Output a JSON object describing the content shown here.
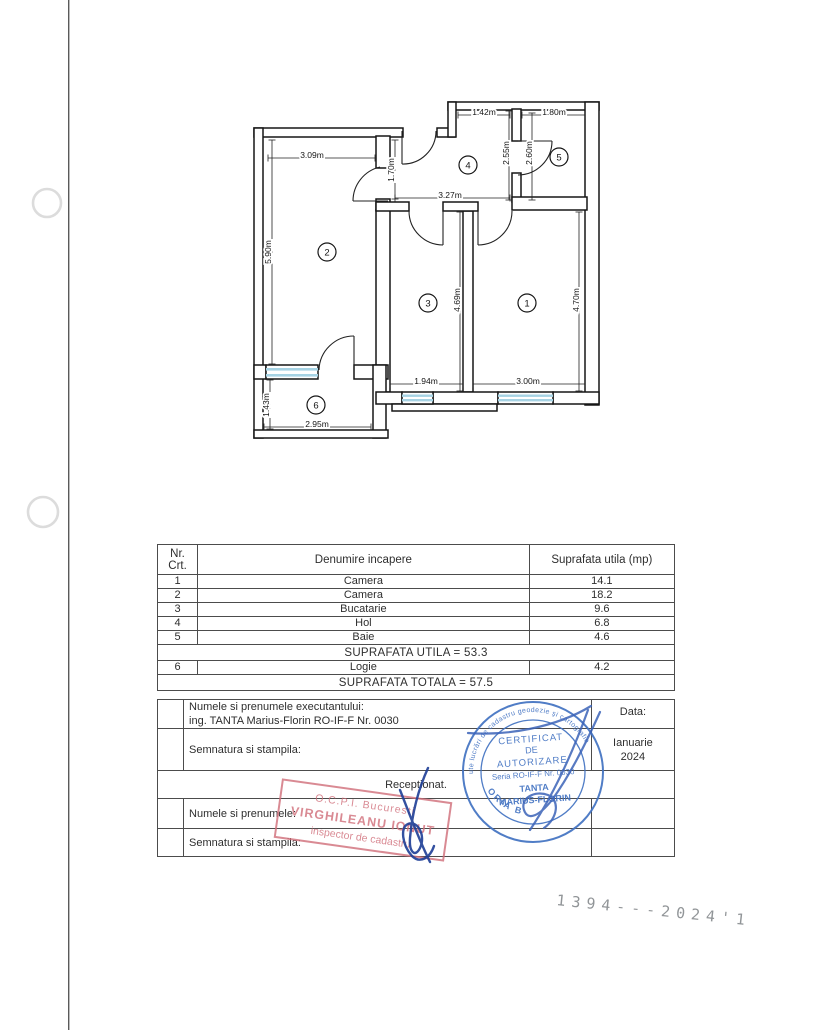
{
  "page": {
    "scan_number": "1394---2024'1"
  },
  "floor_plan": {
    "dims": [
      {
        "t": "3.09m",
        "x": 312,
        "y": 155,
        "v": 0,
        "l": [
          268,
          158,
          375,
          158
        ]
      },
      {
        "t": "5.90m",
        "x": 268,
        "y": 252,
        "v": 1,
        "l": [
          272,
          140,
          272,
          364
        ]
      },
      {
        "t": "1.42m",
        "x": 484,
        "y": 112,
        "v": 0,
        "l": [
          458,
          115,
          510,
          115
        ]
      },
      {
        "t": "1.80m",
        "x": 554,
        "y": 112,
        "v": 0,
        "l": [
          522,
          115,
          585,
          115
        ]
      },
      {
        "t": "1.70m",
        "x": 391,
        "y": 170,
        "v": 1,
        "l": [
          395,
          140,
          395,
          199
        ]
      },
      {
        "t": "2.55m",
        "x": 506,
        "y": 153,
        "v": 1,
        "l": [
          509,
          111,
          509,
          200
        ]
      },
      {
        "t": "2.60m",
        "x": 529,
        "y": 153,
        "v": 1,
        "l": [
          532,
          113,
          532,
          200
        ]
      },
      {
        "t": "3.27m",
        "x": 450,
        "y": 195,
        "v": 0,
        "l": [
          395,
          198,
          510,
          198
        ]
      },
      {
        "t": "4.69m",
        "x": 457,
        "y": 300,
        "v": 1,
        "l": [
          460,
          212,
          460,
          391
        ]
      },
      {
        "t": "4.70m",
        "x": 576,
        "y": 300,
        "v": 1,
        "l": [
          579,
          212,
          579,
          391
        ]
      },
      {
        "t": "1.94m",
        "x": 426,
        "y": 381,
        "v": 0,
        "l": [
          390,
          384,
          463,
          384
        ]
      },
      {
        "t": "3.00m",
        "x": 528,
        "y": 381,
        "v": 0,
        "l": [
          473,
          384,
          585,
          384
        ]
      },
      {
        "t": "1.43m",
        "x": 266,
        "y": 405,
        "v": 1,
        "l": [
          270,
          380,
          270,
          429
        ]
      },
      {
        "t": "2.95m",
        "x": 317,
        "y": 424,
        "v": 0,
        "l": [
          264,
          427,
          371,
          427
        ]
      }
    ],
    "rooms": [
      {
        "n": "1",
        "x": 527,
        "y": 303
      },
      {
        "n": "2",
        "x": 327,
        "y": 252
      },
      {
        "n": "3",
        "x": 428,
        "y": 303
      },
      {
        "n": "4",
        "x": 468,
        "y": 165
      },
      {
        "n": "5",
        "x": 559,
        "y": 157
      },
      {
        "n": "6",
        "x": 316,
        "y": 405
      }
    ]
  },
  "table": {
    "headers": [
      "Nr. Crt.",
      "Denumire incapere",
      "Suprafata utila (mp)"
    ],
    "rows": [
      [
        "1",
        "Camera",
        "14.1"
      ],
      [
        "2",
        "Camera",
        "18.2"
      ],
      [
        "3",
        "Bucatarie",
        "9.6"
      ],
      [
        "4",
        "Hol",
        "6.8"
      ],
      [
        "5",
        "Baie",
        "4.6"
      ]
    ],
    "utila": "SUPRAFATA UTILA = 53.3",
    "row6": [
      "6",
      "Logie",
      "4.2"
    ],
    "totala": "SUPRAFATA TOTALA = 57.5"
  },
  "lower": {
    "exec_label": "Numele si prenumele executantului:",
    "exec_value": "ing. TANTA Marius-Florin RO-IF-F Nr. 0030",
    "data_label": "Data:",
    "sign_label": "Semnatura si stampila:",
    "date_line1": "Ianuarie",
    "date_line2": "2024",
    "receptionat": "Receptionat.",
    "name_label": "Numele si prenumele:",
    "sign2_label": "Semnatura si stampila:"
  },
  "stamps": {
    "blue": {
      "rim": "Persoană fizică autorizată de ANCPI să execute lucrări de cadastru geodezie şi cartografie",
      "l1": "CERTIFICAT",
      "l2": "DE",
      "l3": "AUTORIZARE",
      "l4": "Seria RO-IF-F Nr. 0030",
      "l5": "TANTA",
      "l6": "MARIUS-FLORIN",
      "cat": "CATEGORIA B",
      "color": "#4272c2"
    },
    "red": {
      "l1": "O.C.P.I. Bucuresti",
      "l2": "VIRGHILEANU IONUT",
      "l3": "inspector de cadastru",
      "color": "#d06d79"
    }
  }
}
